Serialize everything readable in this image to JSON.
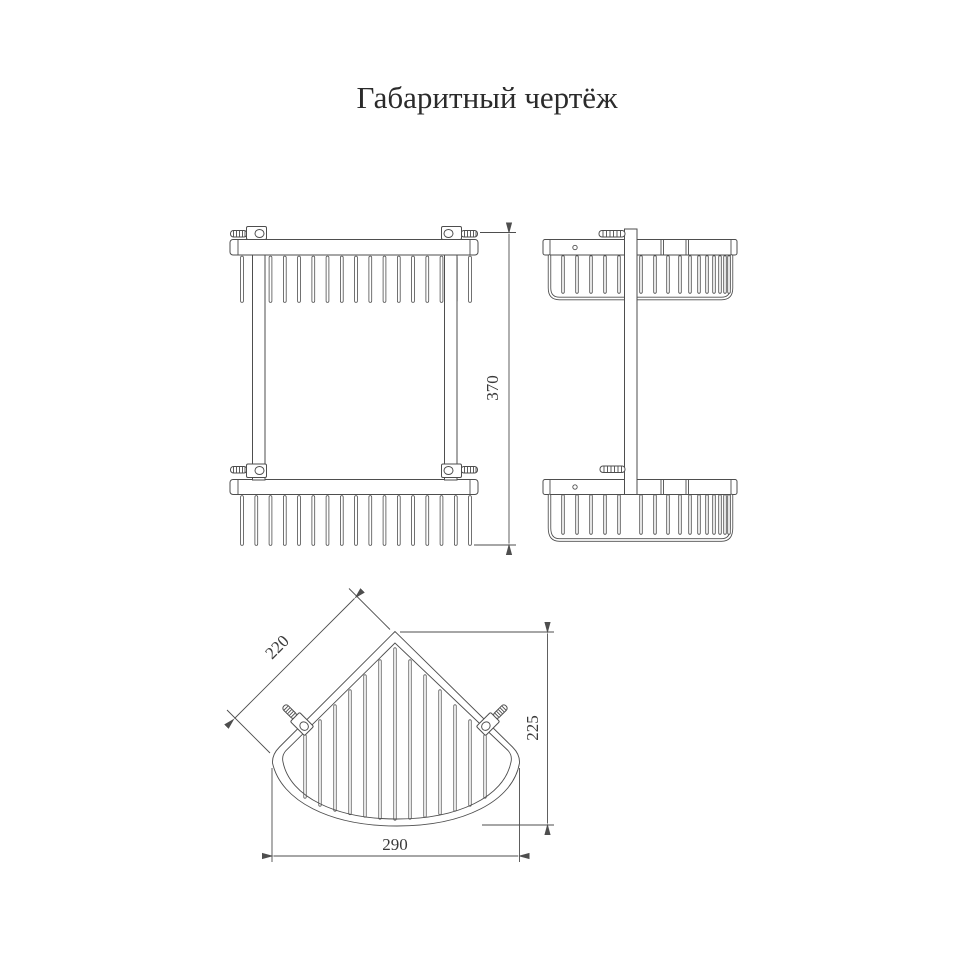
{
  "title": "Габаритный чертёж",
  "drawing": {
    "type": "two-tier corner wire basket, orthographic views",
    "dimensions": {
      "overall_height": "370",
      "shelf_edge": "220",
      "depth": "225",
      "width": "290"
    },
    "line_color": "#4e4e4e",
    "text_color": "#2b2b2b"
  }
}
